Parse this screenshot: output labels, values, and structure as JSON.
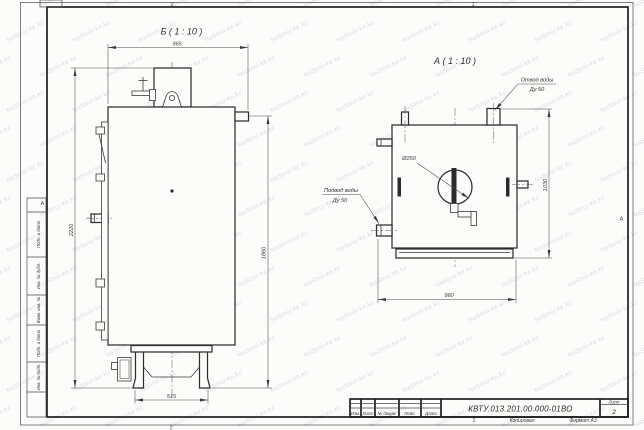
{
  "watermark": {
    "text": "NaStroi-ke.kz"
  },
  "frame": {
    "zones": {
      "top_left": "2",
      "top_right": "1",
      "bottom_left": "2",
      "side_left": "А",
      "side_right": "А"
    }
  },
  "side_panel": {
    "labels": [
      "Подп. и дата",
      "Инв. № дубл.",
      "Взам. инв. №",
      "Подп. и дата",
      "Инв. № подл."
    ]
  },
  "view_b": {
    "label": "Б ( 1 : 10 )",
    "dims": {
      "width": "965",
      "height_total": "2220",
      "height_right": "1860",
      "base_width": "515"
    }
  },
  "view_a": {
    "label": "А ( 1 : 10 )",
    "dims": {
      "width": "960",
      "height": "1030",
      "diameter": "Ø250"
    },
    "callouts": {
      "outlet": [
        "Отвод воды",
        "Ду 50"
      ],
      "inlet": [
        "Подвод воды",
        "Ду 50"
      ]
    }
  },
  "title_block": {
    "designation": "КВТУ.013.201.00.000-01ВО",
    "sheet_label": "Лист",
    "sheet_number": "2",
    "columns": [
      "Изм.",
      "Лист",
      "№ докум.",
      "Подп.",
      "Дата"
    ],
    "footer": {
      "zone": "1",
      "copy": "Копировал",
      "format": "Формат А3"
    }
  }
}
